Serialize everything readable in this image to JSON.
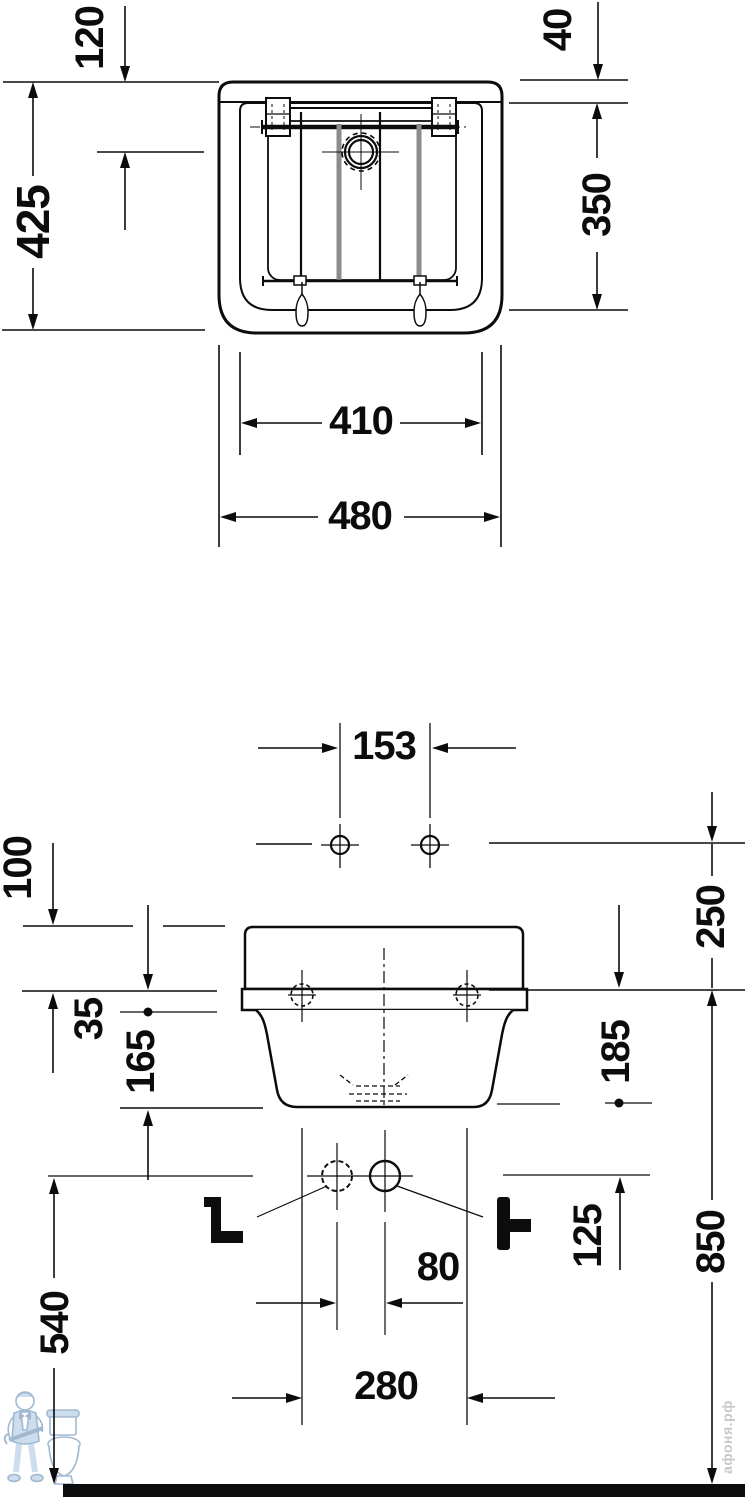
{
  "views": {
    "front": {
      "dimensions": {
        "d120": "120",
        "d425": "425",
        "d40": "40",
        "d350": "350",
        "d410": "410",
        "d480": "480"
      }
    },
    "installation": {
      "dimensions": {
        "d153": "153",
        "d100": "100",
        "d35": "35",
        "d165": "165",
        "d250": "250",
        "d185": "185",
        "d125": "125",
        "d80": "80",
        "d280": "280",
        "d540": "540",
        "d850": "850"
      }
    }
  },
  "watermark": {
    "site_text": "афоня.рф"
  },
  "colors": {
    "line": "#0c0c0c",
    "grid_bar": "#8c8c8c",
    "watermark_text": "#c8c8c8",
    "logo_stroke": "#a0b9d0",
    "logo_fill": "#cddded",
    "background": "#ffffff",
    "floor": "#0c0c0c"
  }
}
